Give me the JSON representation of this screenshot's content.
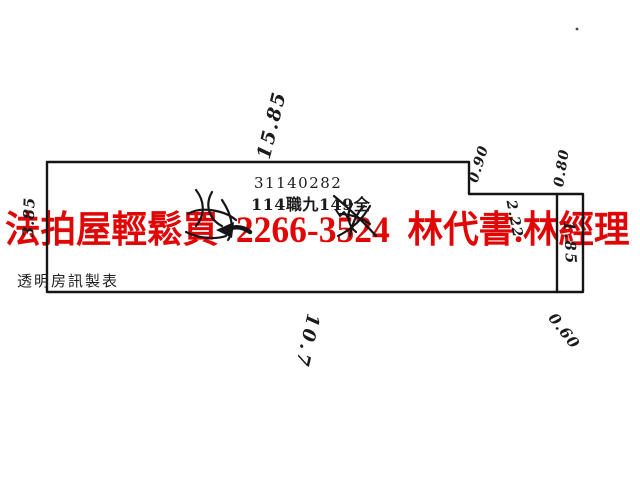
{
  "watermark": {
    "text": "法拍屋輕鬆買  2266-3524  林代書.林經理",
    "color": "#e00606"
  },
  "plan": {
    "parcel_number": "31140282",
    "parcel_label": "114職九149全",
    "caption": "透明房訊製表",
    "ink_color": "#151515"
  },
  "annotations": [
    {
      "id": "dim-top",
      "text": "15.85"
    },
    {
      "id": "dim-left",
      "text": "3.85"
    },
    {
      "id": "dim-step-right",
      "text": "0.90"
    },
    {
      "id": "dim-notch",
      "text": "2.22"
    },
    {
      "id": "dim-strip-top",
      "text": "0.80"
    },
    {
      "id": "dim-strip-inside",
      "text": "1.85"
    },
    {
      "id": "dim-bottom",
      "text": "10.7"
    },
    {
      "id": "dim-bottom-right",
      "text": "0.60"
    }
  ]
}
